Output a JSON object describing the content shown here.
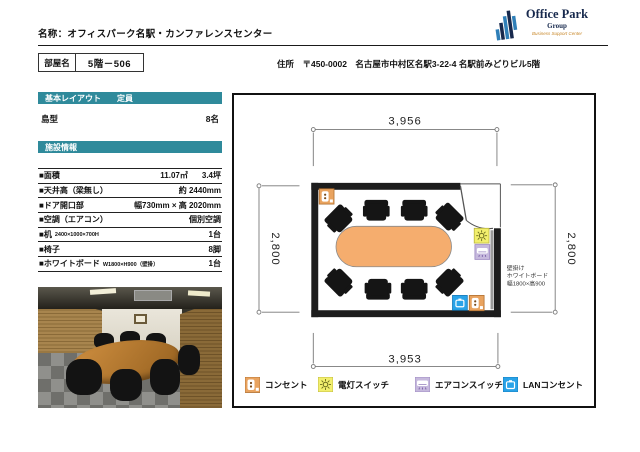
{
  "page": {
    "title": "名称：オフィスパーク名駅・カンファレンスセンター"
  },
  "logo": {
    "name": "Office Park",
    "sub": "Group",
    "tagline": "Business Support Center"
  },
  "room": {
    "label": "部屋名",
    "value": "5階－506"
  },
  "address": "住所　〒450-0002　名古屋市中村区名駅3-22-4 名駅前みどりビル5階",
  "layout": {
    "header_title": "基本レイアウト",
    "header_capacity": "定員",
    "type": "島型",
    "capacity": "8名"
  },
  "facility": {
    "header": "施設情報",
    "rows": [
      {
        "label": "■面積",
        "sub": "",
        "mid": "11.07㎡",
        "value": "3.4坪"
      },
      {
        "label": "■天井高（梁無し）",
        "sub": "",
        "mid": "",
        "value": "約 2440mm"
      },
      {
        "label": "■ドア開口部",
        "sub": "",
        "mid": "",
        "value": "幅730mm × 高 2020mm"
      },
      {
        "label": "■空調（エアコン）",
        "sub": "",
        "mid": "",
        "value": "個別空調"
      },
      {
        "label": "■机",
        "sub": "2400×1000×700H",
        "mid": "",
        "value": "1台"
      },
      {
        "label": "■椅子",
        "sub": "",
        "mid": "",
        "value": "8脚"
      },
      {
        "label": "■ホワイトボード",
        "sub": "W1800×H900（壁掛）",
        "mid": "",
        "value": "1台"
      }
    ]
  },
  "plan": {
    "dim_top": "3,956",
    "dim_bottom": "3,953",
    "dim_left": "2,800",
    "dim_right": "2,800",
    "wb_note1": "壁掛け",
    "wb_note2": "ホワイトボード",
    "wb_note3": "幅1800×高900"
  },
  "legend": {
    "outlet": "コンセント",
    "light": "電灯スイッチ",
    "ac": "エアコンスイッチ",
    "lan": "LANコンセント"
  },
  "colors": {
    "teal": "#2F8A9B",
    "table_orange": "#F5AD6E",
    "outlet_orange": "#E9A35F",
    "switch_yellow": "#F2EF6D",
    "ac_lavender": "#C6B9DD",
    "lan_blue": "#29A3E8"
  }
}
